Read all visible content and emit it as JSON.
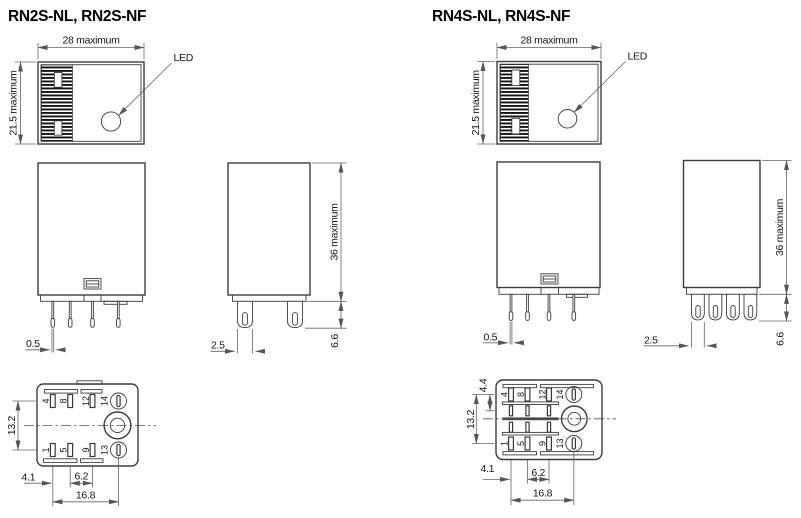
{
  "page": {
    "background": "#ffffff"
  },
  "colors": {
    "outline": "#3d3d3d",
    "dimension_line": "#666666",
    "text": "#161616",
    "hatch": "#141414"
  },
  "left_unit": {
    "title": "RN2S-NL, RN2S-NF",
    "top_view": {
      "width_dim": "28 maximum",
      "height_dim": "21.5 maximum",
      "led_label": "LED"
    },
    "front_view": {
      "terminal_thickness_dim": "0.5"
    },
    "side_view": {
      "body_height_dim": "36 maximum",
      "terminal_length_dim": "6.6",
      "terminal_width_dim": "2.5"
    },
    "bottom_view": {
      "row_pitch_dim": "13.2",
      "edge_to_pin_dim": "4.1",
      "center_pitch_dim": "6.2",
      "overall_pitch_dim": "16.8",
      "pin_labels_top": [
        "4",
        "8",
        "12",
        "14"
      ],
      "pin_labels_bottom": [
        "1",
        "5",
        "9",
        "13"
      ]
    }
  },
  "right_unit": {
    "title": "RN4S-NL, RN4S-NF",
    "top_view": {
      "width_dim": "28 maximum",
      "height_dim": "21.5 maximum",
      "led_label": "LED"
    },
    "front_view": {
      "terminal_thickness_dim": "0.5"
    },
    "side_view": {
      "body_height_dim": "36 maximum",
      "terminal_length_dim": "6.6",
      "terminal_width_dim": "2.5"
    },
    "bottom_view": {
      "row_pitch_dim": "13.2",
      "row_spacing_dim": "4.4",
      "edge_to_pin_dim": "4.1",
      "center_pitch_dim": "6.2",
      "overall_pitch_dim": "16.8",
      "pin_labels_top": [
        "4",
        "8",
        "12",
        "14"
      ],
      "pin_labels_bottom": [
        "1",
        "5",
        "9",
        "13"
      ]
    }
  }
}
